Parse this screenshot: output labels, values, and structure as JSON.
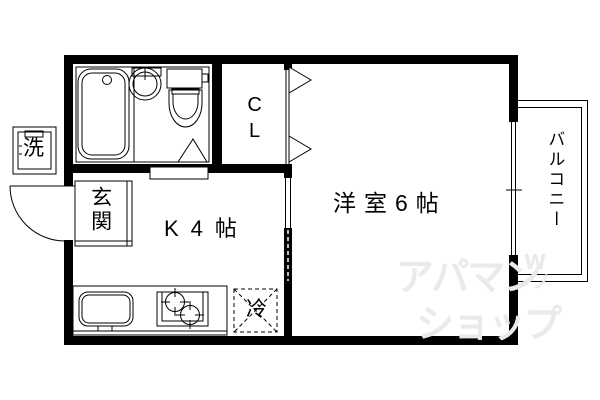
{
  "rooms": {
    "western_room": {
      "label": "洋室6帖"
    },
    "kitchen": {
      "label": "K4帖"
    },
    "closet": {
      "label": "CL"
    },
    "entrance": {
      "label": "玄関"
    },
    "balcony": {
      "label": "バルコニー"
    }
  },
  "fixtures": {
    "washing_machine": {
      "label": "洗"
    },
    "refrigerator": {
      "label": "冷"
    }
  },
  "icons": [
    "bathtub-icon",
    "wash-basin-icon",
    "toilet-icon",
    "bath-door-triangle-icon",
    "closet-folding-door-icon",
    "sliding-door-icon",
    "entrance-door-swing-icon",
    "kitchen-sink-icon",
    "stove-burners-icon",
    "window-icon",
    "balcony-outline"
  ],
  "watermark": {
    "line1": "アパマン",
    "line2": "ショップ",
    "mark": "W",
    "mark2": "ノ",
    "color": "#eaeaea"
  },
  "colors": {
    "line": "#000000",
    "background": "#ffffff"
  }
}
